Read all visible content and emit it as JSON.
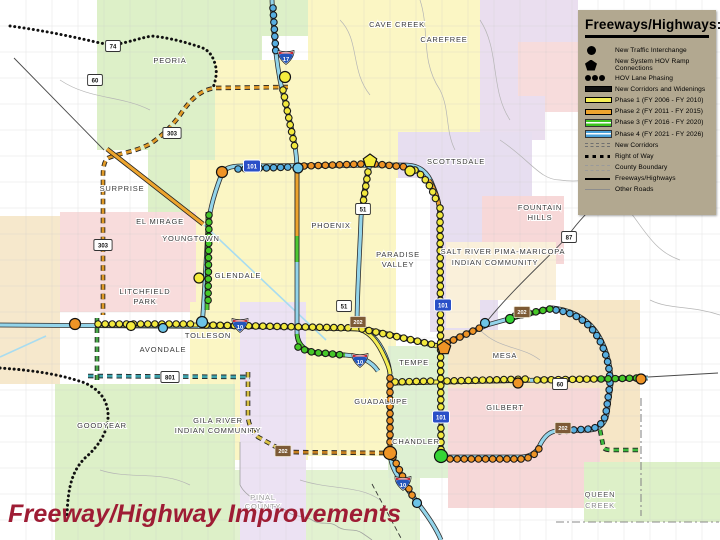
{
  "title": {
    "text": "Freeway/Highway Improvements",
    "color": "#9e1c34"
  },
  "legend": {
    "title": "Freeways/Highways:",
    "bg": "#b2a890",
    "items": [
      {
        "symbol": "circle",
        "label": "New Traffic Interchange"
      },
      {
        "symbol": "pentagon",
        "label": "New System HOV Ramp Connections"
      },
      {
        "symbol": "beads",
        "label": "HOV Lane Phasing"
      },
      {
        "symbol": "bar",
        "color": "#111111",
        "label": "New Corridors and Widenings"
      },
      {
        "symbol": "bar",
        "color": "#f5ee55",
        "label": "Phase 1 (FY 2006 - FY 2010)"
      },
      {
        "symbol": "bar",
        "color": "#eda42e",
        "label": "Phase 2 (FY 2011 - FY 2015)"
      },
      {
        "symbol": "dbl",
        "color": "#3fc41f",
        "label": "Phase 3 (FY 2016 - FY 2020)"
      },
      {
        "symbol": "dbl",
        "color": "#4aa0d8",
        "label": "Phase 4 (FY 2021 - FY 2026)"
      },
      {
        "symbol": "dashes",
        "label": "New Corridors"
      },
      {
        "symbol": "dots",
        "label": "Right of Way"
      },
      {
        "symbol": "county",
        "label": "County Boundary"
      },
      {
        "symbol": "thin",
        "label": "Freeways/Highways"
      },
      {
        "symbol": "thinner",
        "label": "Other Roads"
      }
    ]
  },
  "map": {
    "colors": {
      "existing": "#93d4ea",
      "casing": "#2e2e2e",
      "phase1": "#f5ee55",
      "phase2": "#eda42e",
      "phase3": "#4ec832",
      "phase4": "#57a8e0"
    },
    "regions": [
      {
        "name": "peoria-area",
        "fill": "#ddf0c8",
        "points": "97,0 308,0 308,36 262,36 262,130 215,130 215,232 148,232 148,150 97,150"
      },
      {
        "name": "cave-creek-area",
        "fill": "#fbf6c4",
        "points": "308,0 480,0 480,132 430,132 430,94 360,94 360,60 308,60"
      },
      {
        "name": "carefree-area",
        "fill": "#eadeef",
        "points": "480,0 578,0 578,70 545,70 545,140 480,140"
      },
      {
        "name": "carefree-pink",
        "fill": "#f7dcdc",
        "points": "518,42 578,42 578,112 545,112 545,96 518,96"
      },
      {
        "name": "phoenix-area",
        "fill": "#fbf6c4",
        "points": "215,60 360,60 360,94 430,94 430,178 396,178 396,345 302,345 302,378 232,378 232,302 190,302 190,160 215,160"
      },
      {
        "name": "scottsdale-area",
        "fill": "#e7def0",
        "points": "398,132 532,132 532,196 498,196 498,332 430,332 430,178 398,178"
      },
      {
        "name": "fountain-hills-area",
        "fill": "#f7d8d8",
        "points": "482,196 564,196 564,264 482,264"
      },
      {
        "name": "salt-river-area",
        "fill": "#faf0da",
        "points": "446,242 556,242 556,300 480,300 480,328 446,328"
      },
      {
        "name": "west-pink-area",
        "fill": "#f8dcdc",
        "points": "60,212 196,212 196,312 60,312"
      },
      {
        "name": "far-west-peach",
        "fill": "#f6e8cc",
        "points": "0,216 60,216 60,384 0,384"
      },
      {
        "name": "tolleson-area",
        "fill": "#fbf6c4",
        "points": "190,302 232,302 232,378 302,378 302,345 396,345 396,456 308,456 308,460 190,460"
      },
      {
        "name": "goodyear-area",
        "fill": "#ddf0c8",
        "points": "55,384 235,384 235,540 55,540"
      },
      {
        "name": "south-center-green",
        "fill": "#e2f2d0",
        "points": "235,470 420,470 420,540 235,540"
      },
      {
        "name": "avondale-lavender",
        "fill": "#ece2f3",
        "points": "240,302 306,302 306,540 240,540"
      },
      {
        "name": "mesa-ne-peach",
        "fill": "#f6e6c6",
        "points": "560,300 640,300 640,330 560,330"
      },
      {
        "name": "mesa-area",
        "fill": "#f6e6c6",
        "points": "440,330 640,330 640,472 440,472"
      },
      {
        "name": "tempe-chandler-green",
        "fill": "#def0d2",
        "points": "388,346 448,346 448,478 388,478"
      },
      {
        "name": "gilbert-area",
        "fill": "#f6d8d8",
        "points": "448,388 600,388 600,508 448,508"
      },
      {
        "name": "queen-creek-area",
        "fill": "#ddf0c8",
        "points": "584,462 720,462 720,522 584,522"
      }
    ],
    "canals": [
      {
        "name": "canal-grand",
        "d": "M204,225 L326,340"
      },
      {
        "name": "canal-west",
        "d": "M0,357 L46,336"
      }
    ],
    "minor_roads": [
      {
        "d": "M420,0 C430,30 420,60 440,90 C450,110 445,130 455,150"
      },
      {
        "d": "M480,20 C500,50 490,90 510,120"
      },
      {
        "d": "M340,20 C360,40 350,70 370,95"
      },
      {
        "d": "M500,140 C530,160 540,180 560,180 C590,185 610,170 640,175"
      },
      {
        "d": "M60,80 C90,100 120,95 150,110"
      },
      {
        "d": "M600,60 C620,80 640,75 665,90"
      },
      {
        "d": "M480,330 C500,350 520,345 540,360"
      },
      {
        "d": "M100,470 C130,480 160,470 190,485"
      },
      {
        "d": "M300,480 C330,490 360,485 380,500"
      },
      {
        "d": "M620,200 C640,220 650,250 680,260"
      },
      {
        "d": "M650,300 C670,310 690,305 720,315"
      }
    ],
    "highways_thin": [
      {
        "name": "us60-grand-nw",
        "d": "M14,58 L104,150"
      },
      {
        "name": "sr87",
        "d": "M626,174 C600,200 580,218 568,236 C546,260 514,288 488,320"
      },
      {
        "name": "us60-east-thin",
        "d": "M648,377 L718,373"
      }
    ],
    "county_lines": [
      {
        "name": "county-east-vertical",
        "d": "M641,398 L641,516"
      },
      {
        "name": "county-south-horizontal",
        "d": "M556,522 L719,522"
      }
    ],
    "county_diag": [
      {
        "name": "county-pinal-diagonal",
        "d": "M372,484 L402,540"
      }
    ],
    "river": [
      {
        "name": "gila-river",
        "d": "M240,442 L240,485 C245,495 255,500 262,503 C270,508 280,505 288,512 C296,518 305,515 312,520 C320,526 330,520 338,527 C346,532 355,528 362,533 C368,537 372,540 372,540"
      }
    ],
    "right_of_way": [
      {
        "name": "row-sr74",
        "d": "M10,26 C40,30 70,36 100,43 L113,45 C130,42 140,38 152,36 C170,38 185,42 200,47 C210,50 214,58 216,68 C217,75 215,82 213,88"
      },
      {
        "name": "row-southwest",
        "d": "M0,368 C30,370 60,374 85,383 C100,390 107,400 108,413 C109,430 100,445 85,458 C73,470 68,485 67,515"
      }
    ],
    "corridors": [
      {
        "name": "sr303-corridor",
        "color": "#e09a28",
        "d": "M288,87 L215,88 C200,90 190,100 180,115 C172,126 162,136 150,144 C135,152 120,153 108,158 C104,161 103,168 103,175 L103,315"
      },
      {
        "name": "sr801-corridor",
        "color": "#3fa3ad",
        "d": "M88,376 L250,377"
      },
      {
        "name": "l202-southmtn-west",
        "color": "#d8c044",
        "d": "M248,372 L248,415 C248,424 252,431 258,437 L276,447"
      },
      {
        "name": "l202-southmtn-south",
        "color": "#c57f1f",
        "d": "M284,452 L385,453"
      },
      {
        "name": "sr24-corridor",
        "color": "#3db83d",
        "d": "M600,430 L603,445 C603,449 606,450 612,450 L642,450"
      },
      {
        "name": "west-green-corridor",
        "color": "#4aa84a",
        "d": "M97,318 L97,380"
      }
    ],
    "freeways_existing": [
      {
        "name": "i17",
        "d": "M272,0 C274,42 277,72 285,102 C293,132 297,152 297,170 L297,332 C297,345 304,352 318,353 L345,355 C362,356 372,362 378,371"
      },
      {
        "name": "loop101",
        "d": "M202,326 C205,292 206,258 208,230 C209,214 212,200 221,176 C224,168 230,166 242,166 L404,165 C420,165 428,172 433,186 C438,198 440,206 440,220 L441,456"
      },
      {
        "name": "i10",
        "d": "M0,325 L290,327 C330,329 348,328 358,329 C370,331 379,341 385,355 C389,364 390,370 390,377 L390,450 C390,464 395,473 402,482 L417,502 C428,516 436,528 441,540"
      },
      {
        "name": "sr51",
        "d": "M370,164 C366,180 362,200 361,218 C360,250 357,290 357,328"
      },
      {
        "name": "loop202",
        "d": "M360,328 C385,333 414,341 439,346 L487,325 L512,318 L553,308 C577,311 592,322 601,340 C608,354 611,368 611,384 L607,414 C605,424 599,429 590,430 L556,431 C548,432 543,438 539,447 C535,454 529,457 521,457 L447,457"
      },
      {
        "name": "us60-superstition",
        "d": "M390,383 L648,378"
      }
    ],
    "phase1_segments": [
      {
        "name": "i10-west-a",
        "d": "M95,325 L198,325"
      },
      {
        "name": "i10-west-b",
        "d": "M205,325 L290,327 C330,329 348,328 358,329 C368,331 376,340 382,352 C387,362 390,370 390,374"
      },
      {
        "name": "l202-red-west",
        "d": "M360,328 C385,333 414,341 437,346"
      },
      {
        "name": "us60-a",
        "d": "M390,383 L530,380"
      },
      {
        "name": "us60-b",
        "d": "M537,380 L596,379"
      },
      {
        "name": "sr51-seg",
        "d": "M368,170 L362,212"
      }
    ],
    "phase2_segments": [
      {
        "name": "l101-east",
        "d": "M429,180 C435,190 439,200 440,214 L441,452"
      },
      {
        "name": "i10-south",
        "d": "M390,376 L390,450"
      },
      {
        "name": "us60-grand",
        "d": "M107,149 L203,224"
      },
      {
        "name": "i17-mid",
        "d": "M297,172 L297,236"
      }
    ],
    "phase3_segments": [
      {
        "name": "l101-west",
        "d": "M208,212 L207,310"
      },
      {
        "name": "i17-low",
        "d": "M297,236 L297,262"
      },
      {
        "name": "i17-durango",
        "d": "M297,334 C298,346 306,352 319,353 L345,355"
      },
      {
        "name": "us60-east",
        "d": "M598,379 L646,378"
      },
      {
        "name": "l202-mid",
        "d": "M512,318 L553,308"
      }
    ],
    "beads": {
      "blue": [
        "M273,8 L276,55",
        "M238,169 L291,167",
        "M556,310 C577,313 591,324 600,341 C607,355 610,368 610,384 L606,413 C604,423 598,428 590,429 L554,431"
      ],
      "yellow": [
        "M283,90 L295,148",
        "M98,324 L196,324",
        "M206,325 L355,328",
        "M368,172 L362,210",
        "M415,170 C425,177 432,188 436,200",
        "M440,208 L441,452",
        "M362,329 L435,345",
        "M395,382 L434,381",
        "M447,381 L528,379",
        "M537,380 L594,379"
      ],
      "orange": [
        "M304,166 L363,164",
        "M375,164 L406,167",
        "M390,378 L390,448",
        "M393,457 L414,499",
        "M447,343 L484,326",
        "M450,459 L521,459 C530,459 536,454 540,447"
      ],
      "green": [
        "M209,215 L208,307",
        "M298,347 C306,351 314,353 322,353 L343,355",
        "M515,316 L550,309",
        "M601,379 L639,378"
      ]
    },
    "bead_colors": {
      "blue": "#57aee0",
      "yellow": "#f2e93e",
      "orange": "#ef9426",
      "green": "#46c828"
    },
    "markers": [
      {
        "shape": "circle",
        "x": 285,
        "y": 77,
        "color": "#f5ec3d",
        "r": 5.5,
        "name": "interchange-i17-north"
      },
      {
        "shape": "circle",
        "x": 298,
        "y": 168,
        "color": "#6cc4e8",
        "r": 5,
        "name": "interchange-i17-l101"
      },
      {
        "shape": "circle",
        "x": 222,
        "y": 172,
        "color": "#ef9426",
        "r": 5.5,
        "name": "interchange-l101-nw"
      },
      {
        "shape": "circle",
        "x": 410,
        "y": 171,
        "color": "#f5ec3d",
        "r": 5,
        "name": "interchange-l101-pima"
      },
      {
        "shape": "circle",
        "x": 199,
        "y": 278,
        "color": "#f5ec3d",
        "r": 5,
        "name": "interchange-l101-west"
      },
      {
        "shape": "circle",
        "x": 202,
        "y": 322,
        "color": "#6cc4e8",
        "r": 5.5,
        "name": "interchange-l101-i10"
      },
      {
        "shape": "circle",
        "x": 75,
        "y": 324,
        "color": "#ef9426",
        "r": 5.5,
        "name": "interchange-i10-west"
      },
      {
        "shape": "circle",
        "x": 131,
        "y": 326,
        "color": "#f5ec3d",
        "r": 4.5,
        "name": "interchange-i10-w2"
      },
      {
        "shape": "circle",
        "x": 163,
        "y": 328,
        "color": "#6cc4e8",
        "r": 4.5,
        "name": "interchange-i10-w3"
      },
      {
        "shape": "circle",
        "x": 390,
        "y": 453,
        "color": "#ef9426",
        "r": 6.5,
        "name": "interchange-i10-l202"
      },
      {
        "shape": "circle",
        "x": 441,
        "y": 456,
        "color": "#35d435",
        "r": 6.5,
        "name": "interchange-l101-l202"
      },
      {
        "shape": "circle",
        "x": 417,
        "y": 503,
        "color": "#6cc4e8",
        "r": 4.5,
        "name": "interchange-i10-se"
      },
      {
        "shape": "circle",
        "x": 485,
        "y": 323,
        "color": "#6cc4e8",
        "r": 4.5,
        "name": "interchange-l202-red1"
      },
      {
        "shape": "circle",
        "x": 510,
        "y": 319,
        "color": "#35d435",
        "r": 4.5,
        "name": "interchange-l202-red2"
      },
      {
        "shape": "circle",
        "x": 518,
        "y": 383,
        "color": "#ef9426",
        "r": 5,
        "name": "interchange-us60-mid"
      },
      {
        "shape": "circle",
        "x": 641,
        "y": 379,
        "color": "#ef9426",
        "r": 5,
        "name": "interchange-us60-east"
      },
      {
        "shape": "pentagon",
        "x": 370,
        "y": 161,
        "color": "#f5ec3d",
        "r": 7,
        "name": "hov-ramp-sr51-l101"
      },
      {
        "shape": "pentagon",
        "x": 444,
        "y": 348,
        "color": "#ef9426",
        "r": 7,
        "name": "hov-ramp-l101-l202"
      }
    ],
    "shields": [
      {
        "kind": "state",
        "label": "74",
        "x": 113,
        "y": 46
      },
      {
        "kind": "state",
        "label": "60",
        "x": 95,
        "y": 80
      },
      {
        "kind": "state",
        "label": "303",
        "x": 172,
        "y": 133
      },
      {
        "kind": "state",
        "label": "303",
        "x": 103,
        "y": 245
      },
      {
        "kind": "loop",
        "label": "101",
        "x": 252,
        "y": 166
      },
      {
        "kind": "interstate",
        "label": "17",
        "x": 286,
        "y": 57
      },
      {
        "kind": "state",
        "label": "51",
        "x": 363,
        "y": 209
      },
      {
        "kind": "state",
        "label": "51",
        "x": 344,
        "y": 306
      },
      {
        "kind": "loop",
        "label": "101",
        "x": 443,
        "y": 305
      },
      {
        "kind": "loop",
        "label": "101",
        "x": 441,
        "y": 417
      },
      {
        "kind": "interstate",
        "label": "10",
        "x": 240,
        "y": 325
      },
      {
        "kind": "interstate",
        "label": "10",
        "x": 360,
        "y": 360
      },
      {
        "kind": "interstate",
        "label": "10",
        "x": 403,
        "y": 483
      },
      {
        "kind": "brown",
        "label": "202",
        "x": 358,
        "y": 322
      },
      {
        "kind": "brown",
        "label": "202",
        "x": 522,
        "y": 312
      },
      {
        "kind": "brown",
        "label": "202",
        "x": 563,
        "y": 428
      },
      {
        "kind": "brown",
        "label": "202",
        "x": 283,
        "y": 451
      },
      {
        "kind": "state",
        "label": "801",
        "x": 170,
        "y": 377
      },
      {
        "kind": "state",
        "label": "87",
        "x": 569,
        "y": 237
      },
      {
        "kind": "state",
        "label": "60",
        "x": 560,
        "y": 384
      }
    ],
    "labels": [
      {
        "text": "CAVE CREEK",
        "x": 397,
        "y": 27
      },
      {
        "text": "CAREFREE",
        "x": 444,
        "y": 42
      },
      {
        "text": "PEORIA",
        "x": 170,
        "y": 63
      },
      {
        "text": "SURPRISE",
        "x": 122,
        "y": 191
      },
      {
        "text": "EL MIRAGE",
        "x": 160,
        "y": 224
      },
      {
        "text": "YOUNGTOWN",
        "x": 191,
        "y": 241
      },
      {
        "text": "GLENDALE",
        "x": 238,
        "y": 278
      },
      {
        "text": "LITCHFIELD",
        "x": 145,
        "y": 294
      },
      {
        "text": "PARK",
        "x": 145,
        "y": 304
      },
      {
        "text": "PHOENIX",
        "x": 331,
        "y": 228
      },
      {
        "text": "SCOTTSDALE",
        "x": 456,
        "y": 164
      },
      {
        "text": "PARADISE",
        "x": 398,
        "y": 257
      },
      {
        "text": "VALLEY",
        "x": 398,
        "y": 267
      },
      {
        "text": "FOUNTAIN",
        "x": 540,
        "y": 210
      },
      {
        "text": "HILLS",
        "x": 540,
        "y": 220
      },
      {
        "text": "SALT RIVER PIMA-MARICOPA",
        "x": 503,
        "y": 254
      },
      {
        "text": "INDIAN COMMUNITY",
        "x": 495,
        "y": 265
      },
      {
        "text": "TOLLESON",
        "x": 208,
        "y": 338
      },
      {
        "text": "AVONDALE",
        "x": 163,
        "y": 352
      },
      {
        "text": "GOODYEAR",
        "x": 102,
        "y": 428
      },
      {
        "text": "GILA RIVER",
        "x": 218,
        "y": 423
      },
      {
        "text": "INDIAN COMMUNITY",
        "x": 218,
        "y": 433
      },
      {
        "text": "GUADALUPE",
        "x": 381,
        "y": 404
      },
      {
        "text": "TEMPE",
        "x": 414,
        "y": 365
      },
      {
        "text": "MESA",
        "x": 505,
        "y": 358
      },
      {
        "text": "GILBERT",
        "x": 505,
        "y": 410
      },
      {
        "text": "CHANDLER",
        "x": 416,
        "y": 444
      },
      {
        "text": "QUEEN",
        "x": 600,
        "y": 497,
        "color": "#555555"
      },
      {
        "text": "CREEK",
        "x": 600,
        "y": 508,
        "color": "#888888"
      },
      {
        "text": "PINAL",
        "x": 263,
        "y": 500,
        "color": "#9a9a9a"
      },
      {
        "text": "COUNTY",
        "x": 263,
        "y": 509,
        "color": "#9a9a9a"
      }
    ]
  }
}
